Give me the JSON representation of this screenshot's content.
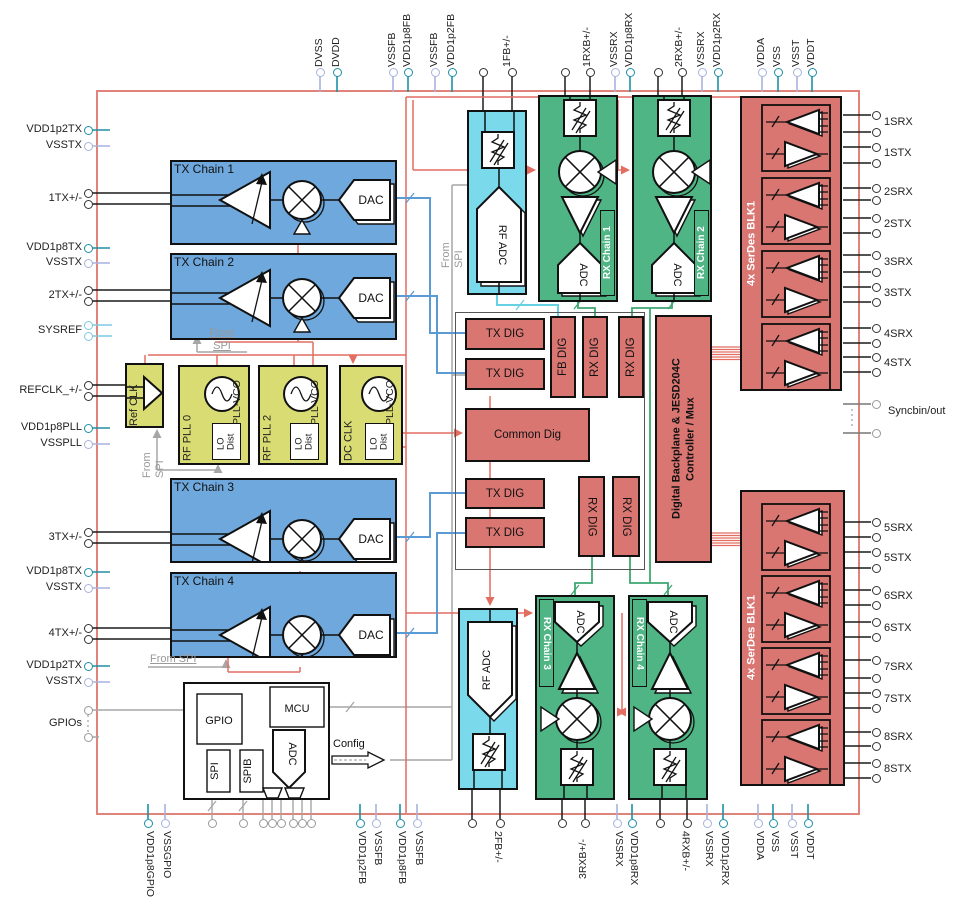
{
  "diagram_title": "RF transceiver functional block diagram",
  "colors": {
    "chip_border": "#E0837B",
    "tx_block": "#6FA8DC",
    "rx_block": "#4FB584",
    "adc_block": "#7BD9EC",
    "clock_block": "#D9DC72",
    "digital_block": "#D97672",
    "wire_red": "#E26D60",
    "wire_blue": "#5B9BD5",
    "wire_cyan": "#66D1E3",
    "wire_green": "#3DA870",
    "wire_gray": "#A6A6A6",
    "wire_black": "#1A1A1A",
    "pin_vdd": "#1E8FA6",
    "pin_vss": "#A8B2DE",
    "pin_sig": "#333333",
    "pin_gray": "#999999",
    "pin_sysref": "#7EC8E3"
  },
  "blocks": {
    "tx_chain_labels": [
      "TX Chain 1",
      "TX Chain 2",
      "TX Chain 3",
      "TX Chain 4"
    ],
    "dac_label": "DAC",
    "rx_chain_labels": [
      "RX Chain 1",
      "RX Chain 2",
      "RX Chain 3",
      "RX Chain 4"
    ],
    "adc_label": "ADC",
    "rf_adc_label": "RF ADC",
    "clock": {
      "ref_clk": "Ref CLK",
      "pll_names": [
        "RF PLL 0",
        "RF PLL 2",
        "DC CLK"
      ],
      "pll_vco": "PLL-VCO",
      "lo_dist": "LO\nDist"
    },
    "digital": {
      "tx_dig": "TX DIG",
      "fb_dig": "FB DIG",
      "rx_dig": "RX DIG",
      "common": "Common Dig",
      "backplane": "Digital Backplane & JESD204C\nController / Mux"
    },
    "serdes_label": "4x SerDes BLK1",
    "mcu": {
      "gpio": "GPIO",
      "mcu": "MCU",
      "spi": "SPI",
      "spib": "SPIB",
      "adc": "ADC"
    }
  },
  "annotations": {
    "from_spi": "From SPI",
    "from_spi_2line": "From\nSPI",
    "config": "Config",
    "syncb": "Syncbin/out"
  },
  "pins": {
    "left": [
      {
        "label": "VDD1p2TX",
        "type": "vdd"
      },
      {
        "label": "VSSTX",
        "type": "vss"
      },
      {
        "label": "1TX+/-",
        "type": "sig2"
      },
      {
        "label": "VDD1p8TX",
        "type": "vdd"
      },
      {
        "label": "VSSTX",
        "type": "vss"
      },
      {
        "label": "2TX+/-",
        "type": "sig2"
      },
      {
        "label": "SYSREF",
        "type": "sysref2"
      },
      {
        "label": "REFCLK_+/-",
        "type": "sig2"
      },
      {
        "label": "VDD1p8PLL",
        "type": "vdd"
      },
      {
        "label": "VSSPLL",
        "type": "vss"
      },
      {
        "label": "3TX+/-",
        "type": "sig2"
      },
      {
        "label": "VDD1p8TX",
        "type": "vdd"
      },
      {
        "label": "VSSTX",
        "type": "vss"
      },
      {
        "label": "4TX+/-",
        "type": "sig2"
      },
      {
        "label": "VDD1p2TX",
        "type": "vdd"
      },
      {
        "label": "VSSTX",
        "type": "vss"
      },
      {
        "label": "GPIOs",
        "type": "gray2"
      }
    ],
    "top": [
      {
        "label": "DVSS",
        "type": "vss"
      },
      {
        "label": "DVDD",
        "type": "vdd"
      },
      {
        "label": "VSSFB",
        "type": "vss"
      },
      {
        "label": "VDD1p8FB",
        "type": "vdd"
      },
      {
        "label": "VSSFB",
        "type": "vss"
      },
      {
        "label": "VDD1p2FB",
        "type": "vdd"
      },
      {
        "label": "1FB+/-",
        "type": "sig2"
      },
      {
        "label": "1RXB+/-",
        "type": "sig2"
      },
      {
        "label": "VSSRX",
        "type": "vss"
      },
      {
        "label": "VDD1p8RX",
        "type": "vdd"
      },
      {
        "label": "2RXB+/-",
        "type": "sig2"
      },
      {
        "label": "VSSRX",
        "type": "vss"
      },
      {
        "label": "VDD1p2RX",
        "type": "vdd"
      },
      {
        "label": "VDDA",
        "type": "vss"
      },
      {
        "label": "VSS",
        "type": "vdd"
      },
      {
        "label": "VSST",
        "type": "vss"
      },
      {
        "label": "VDDT",
        "type": "vdd"
      }
    ],
    "bottom": [
      {
        "label": "VDD1p8GPIO",
        "type": "vdd"
      },
      {
        "label": "VSSGPIO",
        "type": "vss"
      },
      {
        "label": "",
        "type": "gray"
      },
      {
        "label": "",
        "type": "gray"
      },
      {
        "label": "",
        "type": "gray"
      },
      {
        "label": "",
        "type": "gray"
      },
      {
        "label": "",
        "type": "gray"
      },
      {
        "label": "",
        "type": "gray"
      },
      {
        "label": "",
        "type": "gray"
      },
      {
        "label": "",
        "type": "gray"
      },
      {
        "label": "VDD1p2FB",
        "type": "vdd"
      },
      {
        "label": "VSSFB",
        "type": "vss"
      },
      {
        "label": "VDD1p8FB",
        "type": "vdd"
      },
      {
        "label": "VSSFB",
        "type": "vss"
      },
      {
        "label": "2FB+/-",
        "type": "sig2"
      },
      {
        "label": "3RXB+/-",
        "type": "sig2rev"
      },
      {
        "label": "VSSRX",
        "type": "vss"
      },
      {
        "label": "VDD1p8RX",
        "type": "vdd"
      },
      {
        "label": "4RXB+/-",
        "type": "sig2"
      },
      {
        "label": "VSSRX",
        "type": "vss"
      },
      {
        "label": "VDD1p2RX",
        "type": "vdd"
      },
      {
        "label": "VDDA",
        "type": "vss"
      },
      {
        "label": "VSS",
        "type": "vdd"
      },
      {
        "label": "VSST",
        "type": "vss"
      },
      {
        "label": "VDDT",
        "type": "vdd"
      }
    ],
    "right": [
      {
        "label": "1SRX",
        "type": "sig2"
      },
      {
        "label": "1STX",
        "type": "sig2"
      },
      {
        "label": "2SRX",
        "type": "sig2"
      },
      {
        "label": "2STX",
        "type": "sig2"
      },
      {
        "label": "3SRX",
        "type": "sig2"
      },
      {
        "label": "3STX",
        "type": "sig2"
      },
      {
        "label": "4SRX",
        "type": "sig2"
      },
      {
        "label": "4STX",
        "type": "sig2"
      },
      {
        "label": "Syncbin/out",
        "type": "syncb"
      },
      {
        "label": "5SRX",
        "type": "sig2"
      },
      {
        "label": "5STX",
        "type": "sig2"
      },
      {
        "label": "6SRX",
        "type": "sig2"
      },
      {
        "label": "6STX",
        "type": "sig2"
      },
      {
        "label": "7SRX",
        "type": "sig2"
      },
      {
        "label": "7STX",
        "type": "sig2"
      },
      {
        "label": "8SRX",
        "type": "sig2"
      },
      {
        "label": "8STX",
        "type": "sig2"
      }
    ]
  }
}
